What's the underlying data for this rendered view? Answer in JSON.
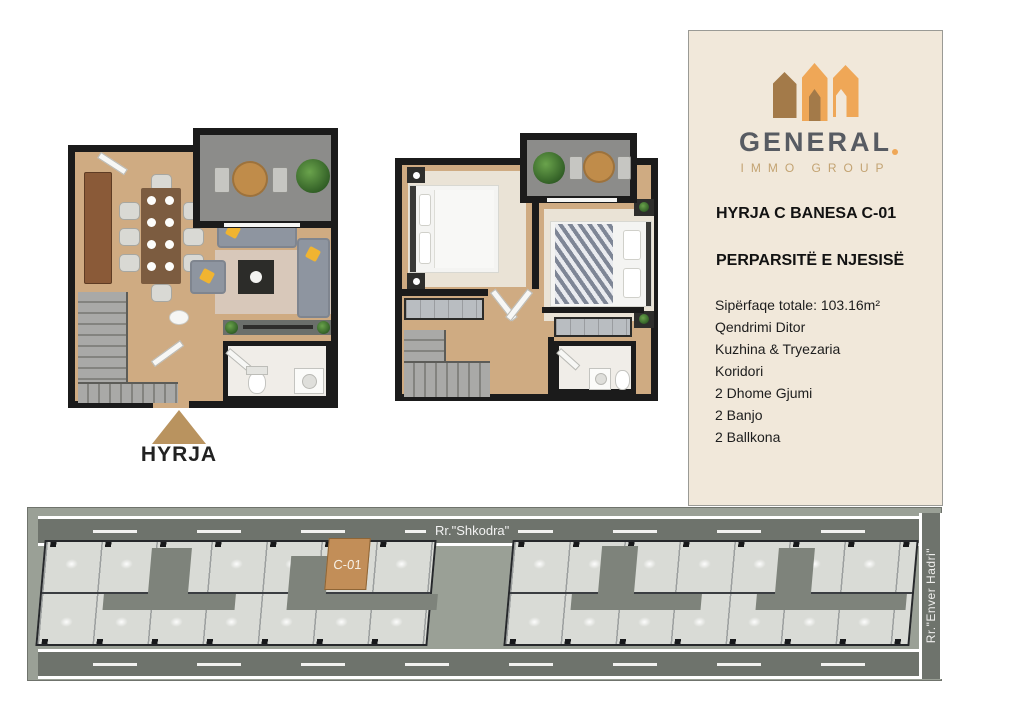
{
  "panel": {
    "brand_name": "GENERAL",
    "brand_subtitle": "IMMO GROUP",
    "unit_title": "HYRJA C BANESA C-01",
    "section_title": "PERPARSITË E NJESISË",
    "details": [
      "Sipërfaqe totale: 103.16m²",
      "Qendrimi Ditor",
      "Kuzhina & Tryezaria",
      "Koridori",
      "2 Dhome Gjumi",
      "2 Banjo",
      "2 Ballkona"
    ]
  },
  "entrance_label": "HYRJA",
  "site_plan": {
    "street_top": "Rr.\"Shkodra\"",
    "street_right": "Rr.\"Enver Hadri\"",
    "highlighted_unit": "C-01"
  },
  "colors": {
    "accent_orange": "#efa757",
    "accent_brown": "#a37a49",
    "panel_background": "#f1e8da",
    "unit_highlight": "#c28e58",
    "road_gray": "#6e736c",
    "wall_black": "#1b1b1b",
    "floor_wood": "#cfab82"
  }
}
